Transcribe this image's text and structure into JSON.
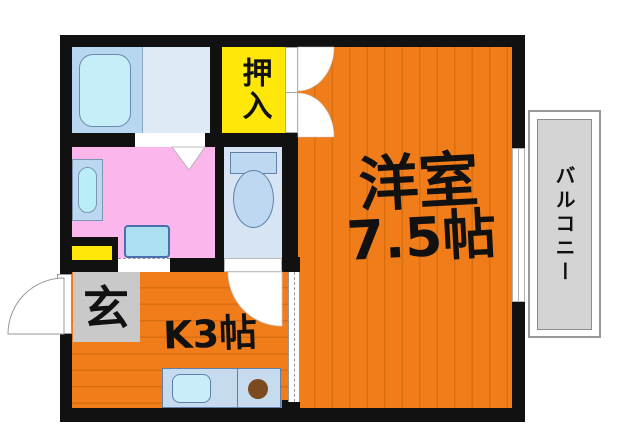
{
  "title": "apartment-floorplan",
  "rooms": {
    "western": {
      "name": "洋室",
      "size": "7.5帖",
      "floor_color": "#F07D1A"
    },
    "kitchen": {
      "label": "K3帖",
      "floor_color": "#F07D1A"
    },
    "closet": {
      "label": "押入",
      "color": "#FFE70A"
    },
    "entrance": {
      "label": "玄",
      "color": "#C9C9C9"
    },
    "balcony": {
      "label": "バルコニー",
      "color": "#D4D4D4"
    },
    "washroom": {
      "color": "#FBB7EC"
    },
    "bathroom": {
      "color": "#B7D6F0"
    },
    "toilet": {
      "color": "#D6E4F4"
    }
  },
  "colors": {
    "wall": "#111111",
    "floor_stripe": "#D96F10",
    "fixture_blue": "#C9EEFA",
    "burner_brown": "#7B4A1F"
  }
}
